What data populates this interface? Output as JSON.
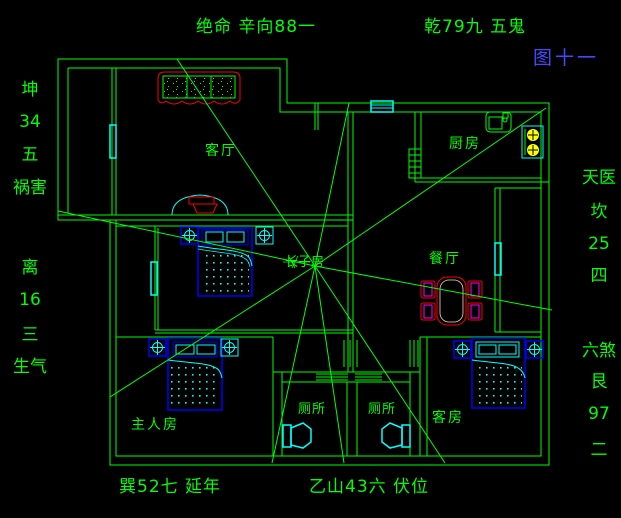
{
  "title": "八宅风水户型图",
  "figure_number": "图十一",
  "annotations": {
    "top_left": "绝命 辛向88一",
    "top_right": "乾79九 五鬼",
    "left": [
      "坤",
      "34",
      "五",
      "祸害",
      "离",
      "16",
      "三",
      "生气"
    ],
    "right": [
      "天医",
      "坎",
      "25",
      "四",
      "六煞",
      "艮",
      "97",
      "二"
    ],
    "bottom_left": "巽52七 延年",
    "bottom_right": "乙山43六 伏位"
  },
  "rooms": {
    "living": "客厅",
    "kitchen": "厨房",
    "dining": "餐厅",
    "eldest_son": "长子房",
    "master": "主人房",
    "toilet_left": "厕所",
    "toilet_right": "厕所",
    "guest": "客房"
  },
  "colors": {
    "background": "#000000",
    "wall_line": "#00ff00",
    "window_fixture": "#00ffff",
    "furniture_frame": "#0000ff",
    "accent_red": "#ff0000",
    "chair_magenta": "#ff00ff",
    "burner_yellow": "#ffff00",
    "figure_label_blue": "#4747ff"
  },
  "icons": {
    "lamp": "ceiling-lamp-icon",
    "toilet": "toilet-icon",
    "sink": "kitchen-sink-icon",
    "stove": "stove-icon"
  }
}
